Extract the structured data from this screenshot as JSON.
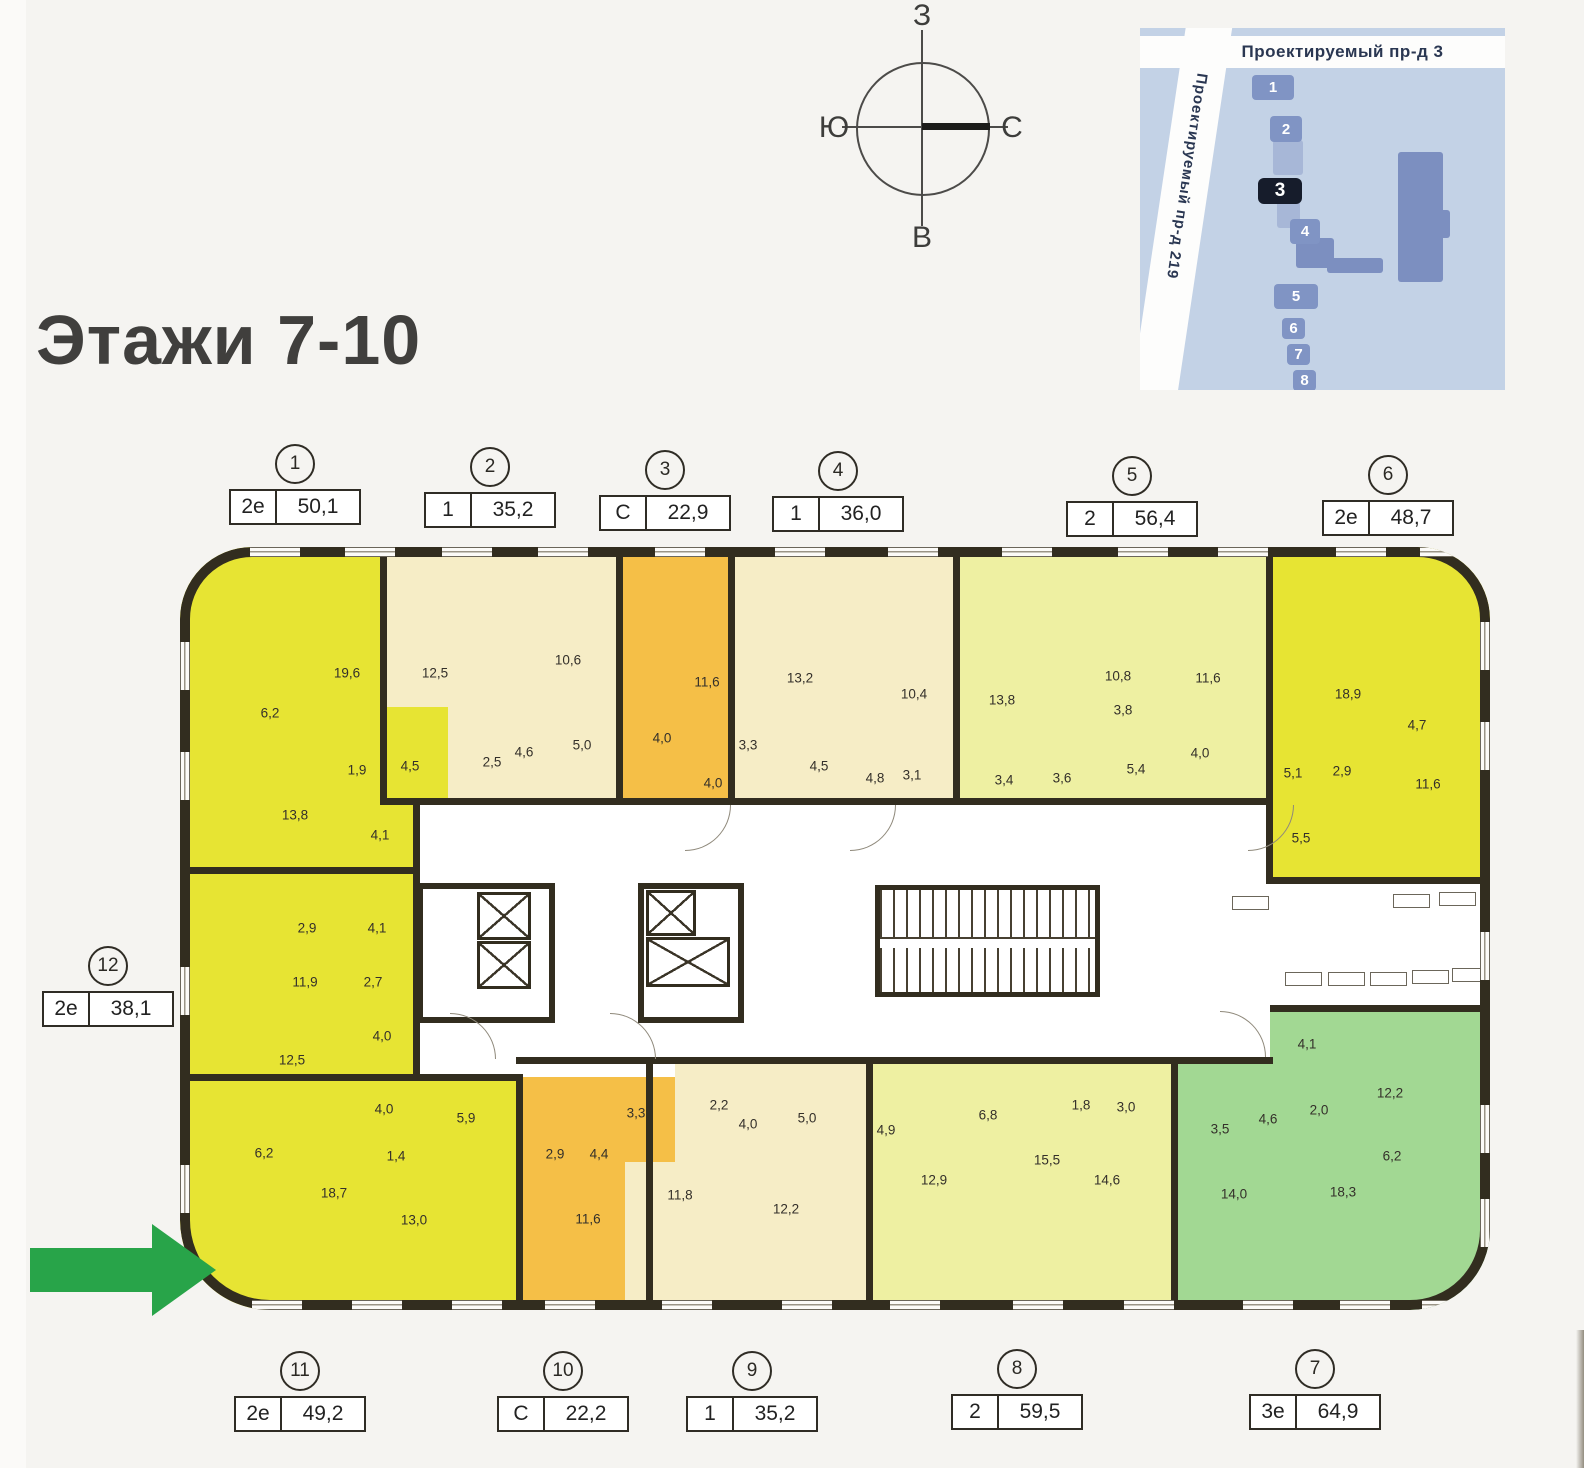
{
  "page": {
    "title": "Этажи 7-10"
  },
  "compass": {
    "top": "З",
    "right": "С",
    "bottom": "В",
    "left": "Ю"
  },
  "site_map": {
    "street_top": "Проектируемый пр-д 3",
    "street_side": "Проектируемый пр-д 219",
    "buildings": [
      {
        "n": "1",
        "x": 112,
        "y": 47,
        "w": 42,
        "h": 25,
        "hl": false
      },
      {
        "n": "2",
        "x": 130,
        "y": 88,
        "w": 32,
        "h": 26,
        "hl": false
      },
      {
        "n": "3",
        "x": 118,
        "y": 150,
        "w": 44,
        "h": 26,
        "hl": true
      },
      {
        "n": "4",
        "x": 150,
        "y": 191,
        "w": 30,
        "h": 25,
        "hl": false
      },
      {
        "n": "5",
        "x": 134,
        "y": 256,
        "w": 44,
        "h": 25,
        "hl": false
      },
      {
        "n": "6",
        "x": 142,
        "y": 290,
        "w": 23,
        "h": 21,
        "hl": false
      },
      {
        "n": "7",
        "x": 147,
        "y": 316,
        "w": 23,
        "h": 21,
        "hl": false
      },
      {
        "n": "8",
        "x": 153,
        "y": 342,
        "w": 23,
        "h": 21,
        "hl": false
      }
    ]
  },
  "apartments": [
    {
      "id": "1",
      "type": "2е",
      "area": "50,1",
      "x": 295,
      "y": 444,
      "side": "top"
    },
    {
      "id": "2",
      "type": "1",
      "area": "35,2",
      "x": 490,
      "y": 447,
      "side": "top"
    },
    {
      "id": "3",
      "type": "С",
      "area": "22,9",
      "x": 665,
      "y": 450,
      "side": "top"
    },
    {
      "id": "4",
      "type": "1",
      "area": "36,0",
      "x": 838,
      "y": 451,
      "side": "top"
    },
    {
      "id": "5",
      "type": "2",
      "area": "56,4",
      "x": 1132,
      "y": 456,
      "side": "top"
    },
    {
      "id": "6",
      "type": "2е",
      "area": "48,7",
      "x": 1388,
      "y": 455,
      "side": "top"
    },
    {
      "id": "7",
      "type": "3е",
      "area": "64,9",
      "x": 1315,
      "y": 1349,
      "side": "bottom"
    },
    {
      "id": "8",
      "type": "2",
      "area": "59,5",
      "x": 1017,
      "y": 1349,
      "side": "bottom"
    },
    {
      "id": "9",
      "type": "1",
      "area": "35,2",
      "x": 752,
      "y": 1351,
      "side": "bottom"
    },
    {
      "id": "10",
      "type": "С",
      "area": "22,2",
      "x": 563,
      "y": 1351,
      "side": "bottom"
    },
    {
      "id": "11",
      "type": "2е",
      "area": "49,2",
      "x": 300,
      "y": 1351,
      "side": "bottom"
    },
    {
      "id": "12",
      "type": "2е",
      "area": "38,1",
      "x": 108,
      "y": 946,
      "side": "left"
    }
  ],
  "rooms": [
    {
      "apt": "1",
      "v": "19,6",
      "x": 167,
      "y": 126
    },
    {
      "apt": "1",
      "v": "6,2",
      "x": 90,
      "y": 166
    },
    {
      "apt": "1",
      "v": "1,9",
      "x": 177,
      "y": 223
    },
    {
      "apt": "1",
      "v": "4,5",
      "x": 230,
      "y": 219
    },
    {
      "apt": "1",
      "v": "13,8",
      "x": 115,
      "y": 268
    },
    {
      "apt": "1",
      "v": "4,1",
      "x": 200,
      "y": 288
    },
    {
      "apt": "2",
      "v": "12,5",
      "x": 255,
      "y": 126
    },
    {
      "apt": "2",
      "v": "10,6",
      "x": 388,
      "y": 113
    },
    {
      "apt": "2",
      "v": "2,5",
      "x": 312,
      "y": 215
    },
    {
      "apt": "2",
      "v": "4,6",
      "x": 344,
      "y": 205
    },
    {
      "apt": "2",
      "v": "5,0",
      "x": 402,
      "y": 198
    },
    {
      "apt": "3",
      "v": "11,6",
      "x": 527,
      "y": 135
    },
    {
      "apt": "3",
      "v": "4,0",
      "x": 482,
      "y": 191
    },
    {
      "apt": "3",
      "v": "3,3",
      "x": 568,
      "y": 198
    },
    {
      "apt": "3",
      "v": "4,0",
      "x": 533,
      "y": 236
    },
    {
      "apt": "4",
      "v": "13,2",
      "x": 620,
      "y": 131
    },
    {
      "apt": "4",
      "v": "10,4",
      "x": 734,
      "y": 147
    },
    {
      "apt": "4",
      "v": "4,5",
      "x": 639,
      "y": 219
    },
    {
      "apt": "4",
      "v": "4,8",
      "x": 695,
      "y": 231
    },
    {
      "apt": "4",
      "v": "3,1",
      "x": 732,
      "y": 228
    },
    {
      "apt": "5",
      "v": "13,8",
      "x": 822,
      "y": 153
    },
    {
      "apt": "5",
      "v": "10,8",
      "x": 938,
      "y": 129
    },
    {
      "apt": "5",
      "v": "3,8",
      "x": 943,
      "y": 163
    },
    {
      "apt": "5",
      "v": "11,6",
      "x": 1028,
      "y": 131
    },
    {
      "apt": "5",
      "v": "3,4",
      "x": 824,
      "y": 233
    },
    {
      "apt": "5",
      "v": "3,6",
      "x": 882,
      "y": 231
    },
    {
      "apt": "5",
      "v": "5,4",
      "x": 956,
      "y": 222
    },
    {
      "apt": "5",
      "v": "4,0",
      "x": 1020,
      "y": 206
    },
    {
      "apt": "6",
      "v": "18,9",
      "x": 1168,
      "y": 147
    },
    {
      "apt": "6",
      "v": "4,7",
      "x": 1237,
      "y": 178
    },
    {
      "apt": "6",
      "v": "5,1",
      "x": 1113,
      "y": 226
    },
    {
      "apt": "6",
      "v": "2,9",
      "x": 1162,
      "y": 224
    },
    {
      "apt": "6",
      "v": "11,6",
      "x": 1248,
      "y": 237
    },
    {
      "apt": "6",
      "v": "5,5",
      "x": 1121,
      "y": 291
    },
    {
      "apt": "12",
      "v": "2,9",
      "x": 127,
      "y": 381
    },
    {
      "apt": "12",
      "v": "4,1",
      "x": 197,
      "y": 381
    },
    {
      "apt": "12",
      "v": "11,9",
      "x": 125,
      "y": 435
    },
    {
      "apt": "12",
      "v": "2,7",
      "x": 193,
      "y": 435
    },
    {
      "apt": "12",
      "v": "4,0",
      "x": 202,
      "y": 489
    },
    {
      "apt": "12",
      "v": "12,5",
      "x": 112,
      "y": 513
    },
    {
      "apt": "11",
      "v": "4,0",
      "x": 204,
      "y": 562
    },
    {
      "apt": "11",
      "v": "5,9",
      "x": 286,
      "y": 571
    },
    {
      "apt": "11",
      "v": "6,2",
      "x": 84,
      "y": 606
    },
    {
      "apt": "11",
      "v": "1,4",
      "x": 216,
      "y": 609
    },
    {
      "apt": "11",
      "v": "18,7",
      "x": 154,
      "y": 646
    },
    {
      "apt": "11",
      "v": "13,0",
      "x": 234,
      "y": 673
    },
    {
      "apt": "10",
      "v": "3,3",
      "x": 456,
      "y": 566
    },
    {
      "apt": "10",
      "v": "2,9",
      "x": 375,
      "y": 607
    },
    {
      "apt": "10",
      "v": "4,4",
      "x": 419,
      "y": 607
    },
    {
      "apt": "10",
      "v": "11,6",
      "x": 408,
      "y": 672
    },
    {
      "apt": "9",
      "v": "2,2",
      "x": 539,
      "y": 558
    },
    {
      "apt": "9",
      "v": "4,0",
      "x": 568,
      "y": 577
    },
    {
      "apt": "9",
      "v": "5,0",
      "x": 627,
      "y": 571
    },
    {
      "apt": "9",
      "v": "11,8",
      "x": 500,
      "y": 648
    },
    {
      "apt": "9",
      "v": "12,2",
      "x": 606,
      "y": 662
    },
    {
      "apt": "8",
      "v": "4,9",
      "x": 706,
      "y": 583
    },
    {
      "apt": "8",
      "v": "6,8",
      "x": 808,
      "y": 568
    },
    {
      "apt": "8",
      "v": "1,8",
      "x": 901,
      "y": 558
    },
    {
      "apt": "8",
      "v": "3,0",
      "x": 946,
      "y": 560
    },
    {
      "apt": "8",
      "v": "12,9",
      "x": 754,
      "y": 633
    },
    {
      "apt": "8",
      "v": "15,5",
      "x": 867,
      "y": 613
    },
    {
      "apt": "8",
      "v": "14,6",
      "x": 927,
      "y": 633
    },
    {
      "apt": "7",
      "v": "4,1",
      "x": 1127,
      "y": 497
    },
    {
      "apt": "7",
      "v": "12,2",
      "x": 1210,
      "y": 546
    },
    {
      "apt": "7",
      "v": "2,0",
      "x": 1139,
      "y": 563
    },
    {
      "apt": "7",
      "v": "4,6",
      "x": 1088,
      "y": 572
    },
    {
      "apt": "7",
      "v": "3,5",
      "x": 1040,
      "y": 582
    },
    {
      "apt": "7",
      "v": "6,2",
      "x": 1212,
      "y": 609
    },
    {
      "apt": "7",
      "v": "14,0",
      "x": 1054,
      "y": 647
    },
    {
      "apt": "7",
      "v": "18,3",
      "x": 1163,
      "y": 645
    }
  ],
  "colors": {
    "yellow": "#e7e433",
    "cream": "#f6edc6",
    "orange": "#f5bf47",
    "pale": "#eef0a2",
    "green": "#a2d893",
    "wall": "#322d1f",
    "arrow_green": "#28a449",
    "map_bg": "#c3d2e6",
    "map_building": "#8094c4",
    "map_highlight": "#161c2b"
  }
}
